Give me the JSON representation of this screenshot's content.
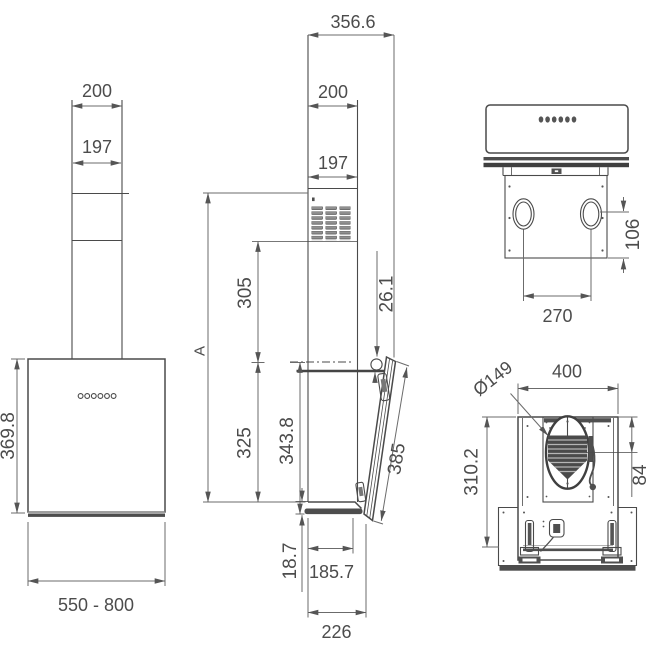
{
  "drawing": {
    "ink_color": "#4a4a4a",
    "background": "#ffffff",
    "views": {
      "front": {
        "dims": {
          "chimney_outer": "200",
          "chimney_inner": "197",
          "body_height": "369.8",
          "width_range": "550 - 800"
        }
      },
      "side": {
        "dims": {
          "total_depth": "356.6",
          "chimney_outer": "200",
          "chimney_inner": "197",
          "vent_height": "305",
          "panel_top_offset": "26.1",
          "height_marker": "A",
          "body_height": "325",
          "front_height": "343.8",
          "panel_length": "385",
          "glass_overhang": "18.7",
          "body_depth": "185.7",
          "total_bottom_depth": "226"
        }
      },
      "top": {
        "dims": {
          "hole_offset": "106",
          "hole_spacing": "270"
        }
      },
      "bottom": {
        "dims": {
          "outlet_diameter": "Ø149",
          "width": "400",
          "depth": "310.2",
          "outlet_offset": "84"
        }
      }
    }
  }
}
